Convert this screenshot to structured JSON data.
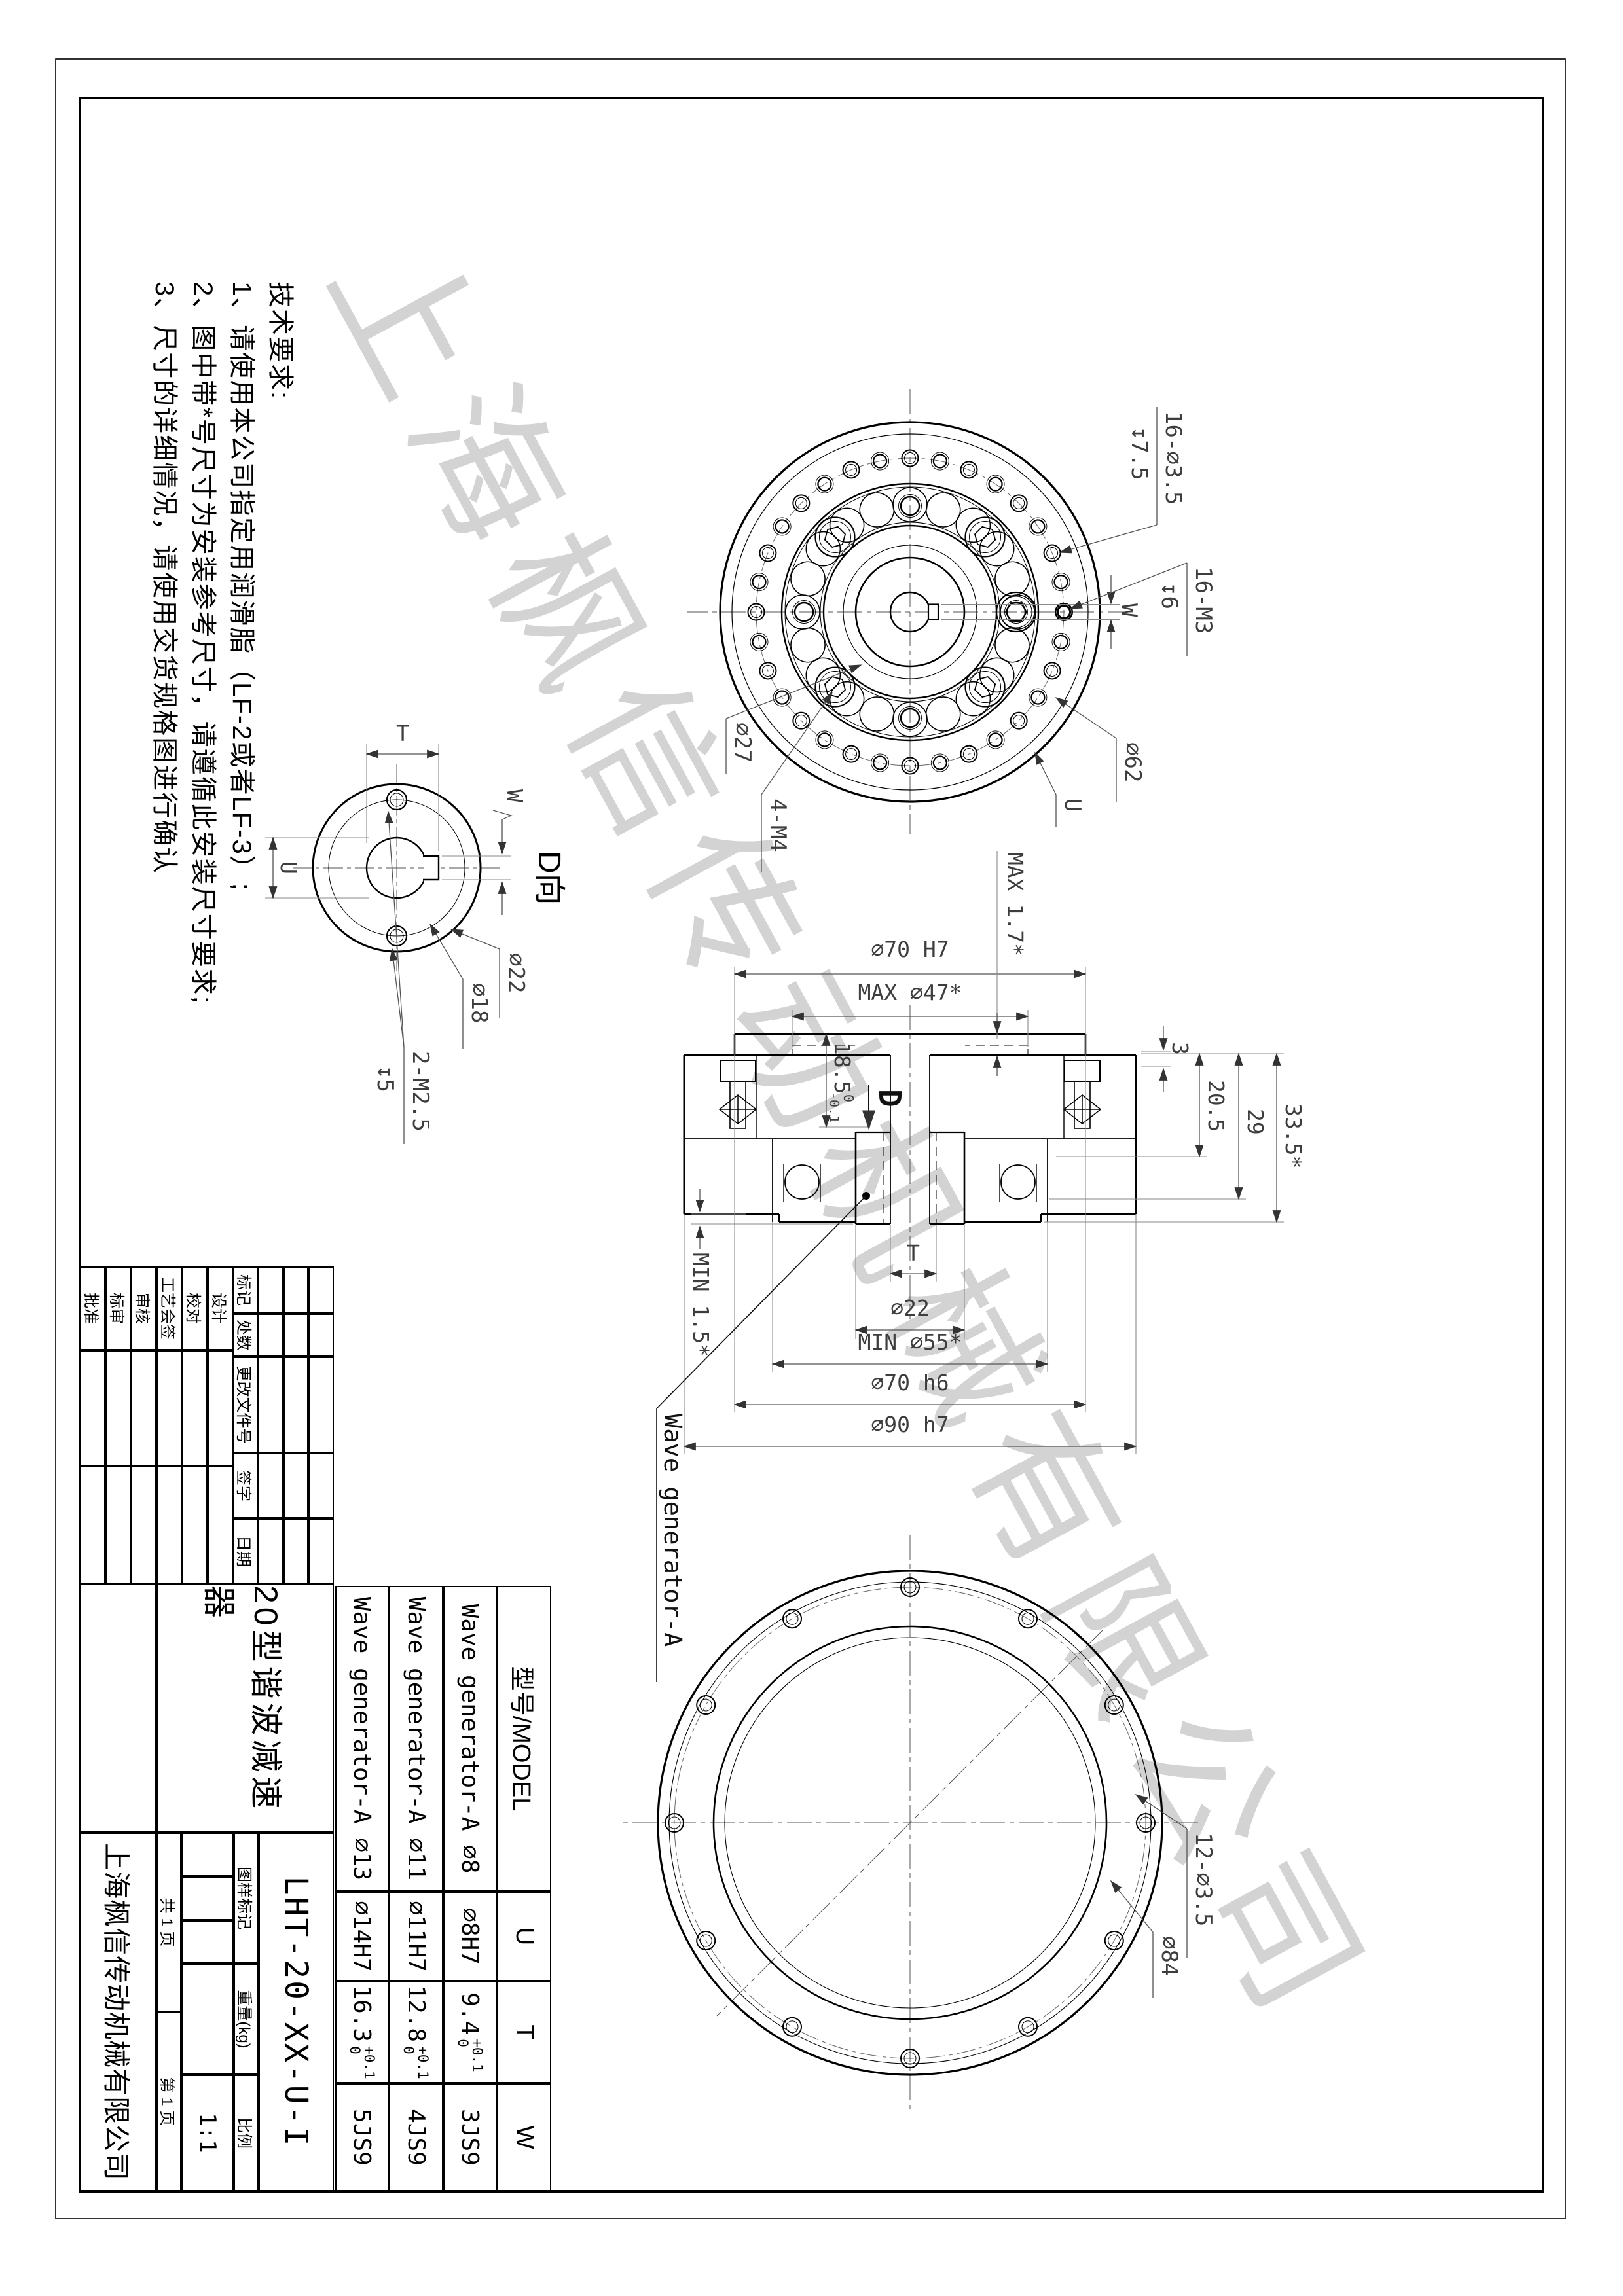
{
  "tech_requirements": {
    "title": "技术要求:",
    "items": [
      "1、请使用本公司指定用润滑脂（LF-2或者LF-3）;",
      "2、图中带*号尺寸为安装参考尺寸，请遵循此安装尺寸要求;",
      "3、尺寸的详细情况，请使用交货规格图进行确认"
    ]
  },
  "watermark": "上海枫信传动机械有限公司",
  "front_view": {
    "holes_clearance": "16-∅3.5",
    "holes_clearance_depth": "↧7.5",
    "holes_tapped": "16-M3",
    "holes_tapped_depth": "↧6",
    "keyway_width": "W",
    "bolt_circle": "∅62",
    "bore": "U",
    "inner_circle": "∅27",
    "tapped_4": "4-M4"
  },
  "section_view": {
    "bore_h7": "∅70 H7",
    "max_47": "MAX ∅47*",
    "max_17": "MAX 1.7*",
    "d185": "18.5",
    "d185_up": "0",
    "d185_dn": "-0.1",
    "d3": "3",
    "d205": "20.5",
    "d29": "29",
    "d335": "33.5*",
    "min_15": "MIN 1.5*",
    "d22": "∅22",
    "t": "T",
    "min_55": "MIN ∅55*",
    "d70h6": "∅70 h6",
    "d90h7": "∅90 h7",
    "view_mark": "D",
    "callout": "Wave generator-A"
  },
  "d_view": {
    "title": "D向",
    "t": "T",
    "w": "W",
    "u": "U",
    "d22": "∅22",
    "d18": "∅18",
    "m25": "2-M2.5",
    "m25_depth": "↧5"
  },
  "back_view": {
    "holes": "12-∅3.5",
    "bolt_circle": "∅84"
  },
  "model_table": {
    "header": [
      "型号/MODEL",
      "U",
      "T",
      "W"
    ],
    "tol_up": "+0.1",
    "tol_dn": "0",
    "rows": [
      [
        "Wave generator-A ∅8",
        "∅8H7",
        "9.4",
        "3JS9"
      ],
      [
        "Wave generator-A ∅11",
        "∅11H7",
        "12.8",
        "4JS9"
      ],
      [
        "Wave generator-A ∅13",
        "∅14H7",
        "16.3",
        "5JS9"
      ]
    ]
  },
  "title_block": {
    "revision_cols": [
      "标记",
      "处数",
      "更改文件号",
      "签字",
      "日期"
    ],
    "sign_rows": [
      "设计",
      "校对",
      "工艺会签",
      "审核",
      "标审",
      "批准"
    ],
    "product_name": "20型谐波减速器",
    "drawing_number": "LHT-20-XX-U-I",
    "stamp_label": "图样标记",
    "weight_label": "重量(kg)",
    "scale_label": "比例",
    "scale_value": "1:1",
    "pages_total": "共 1 页",
    "pages_page": "第 1 页",
    "company": "上海枫信传动机械有限公司"
  }
}
